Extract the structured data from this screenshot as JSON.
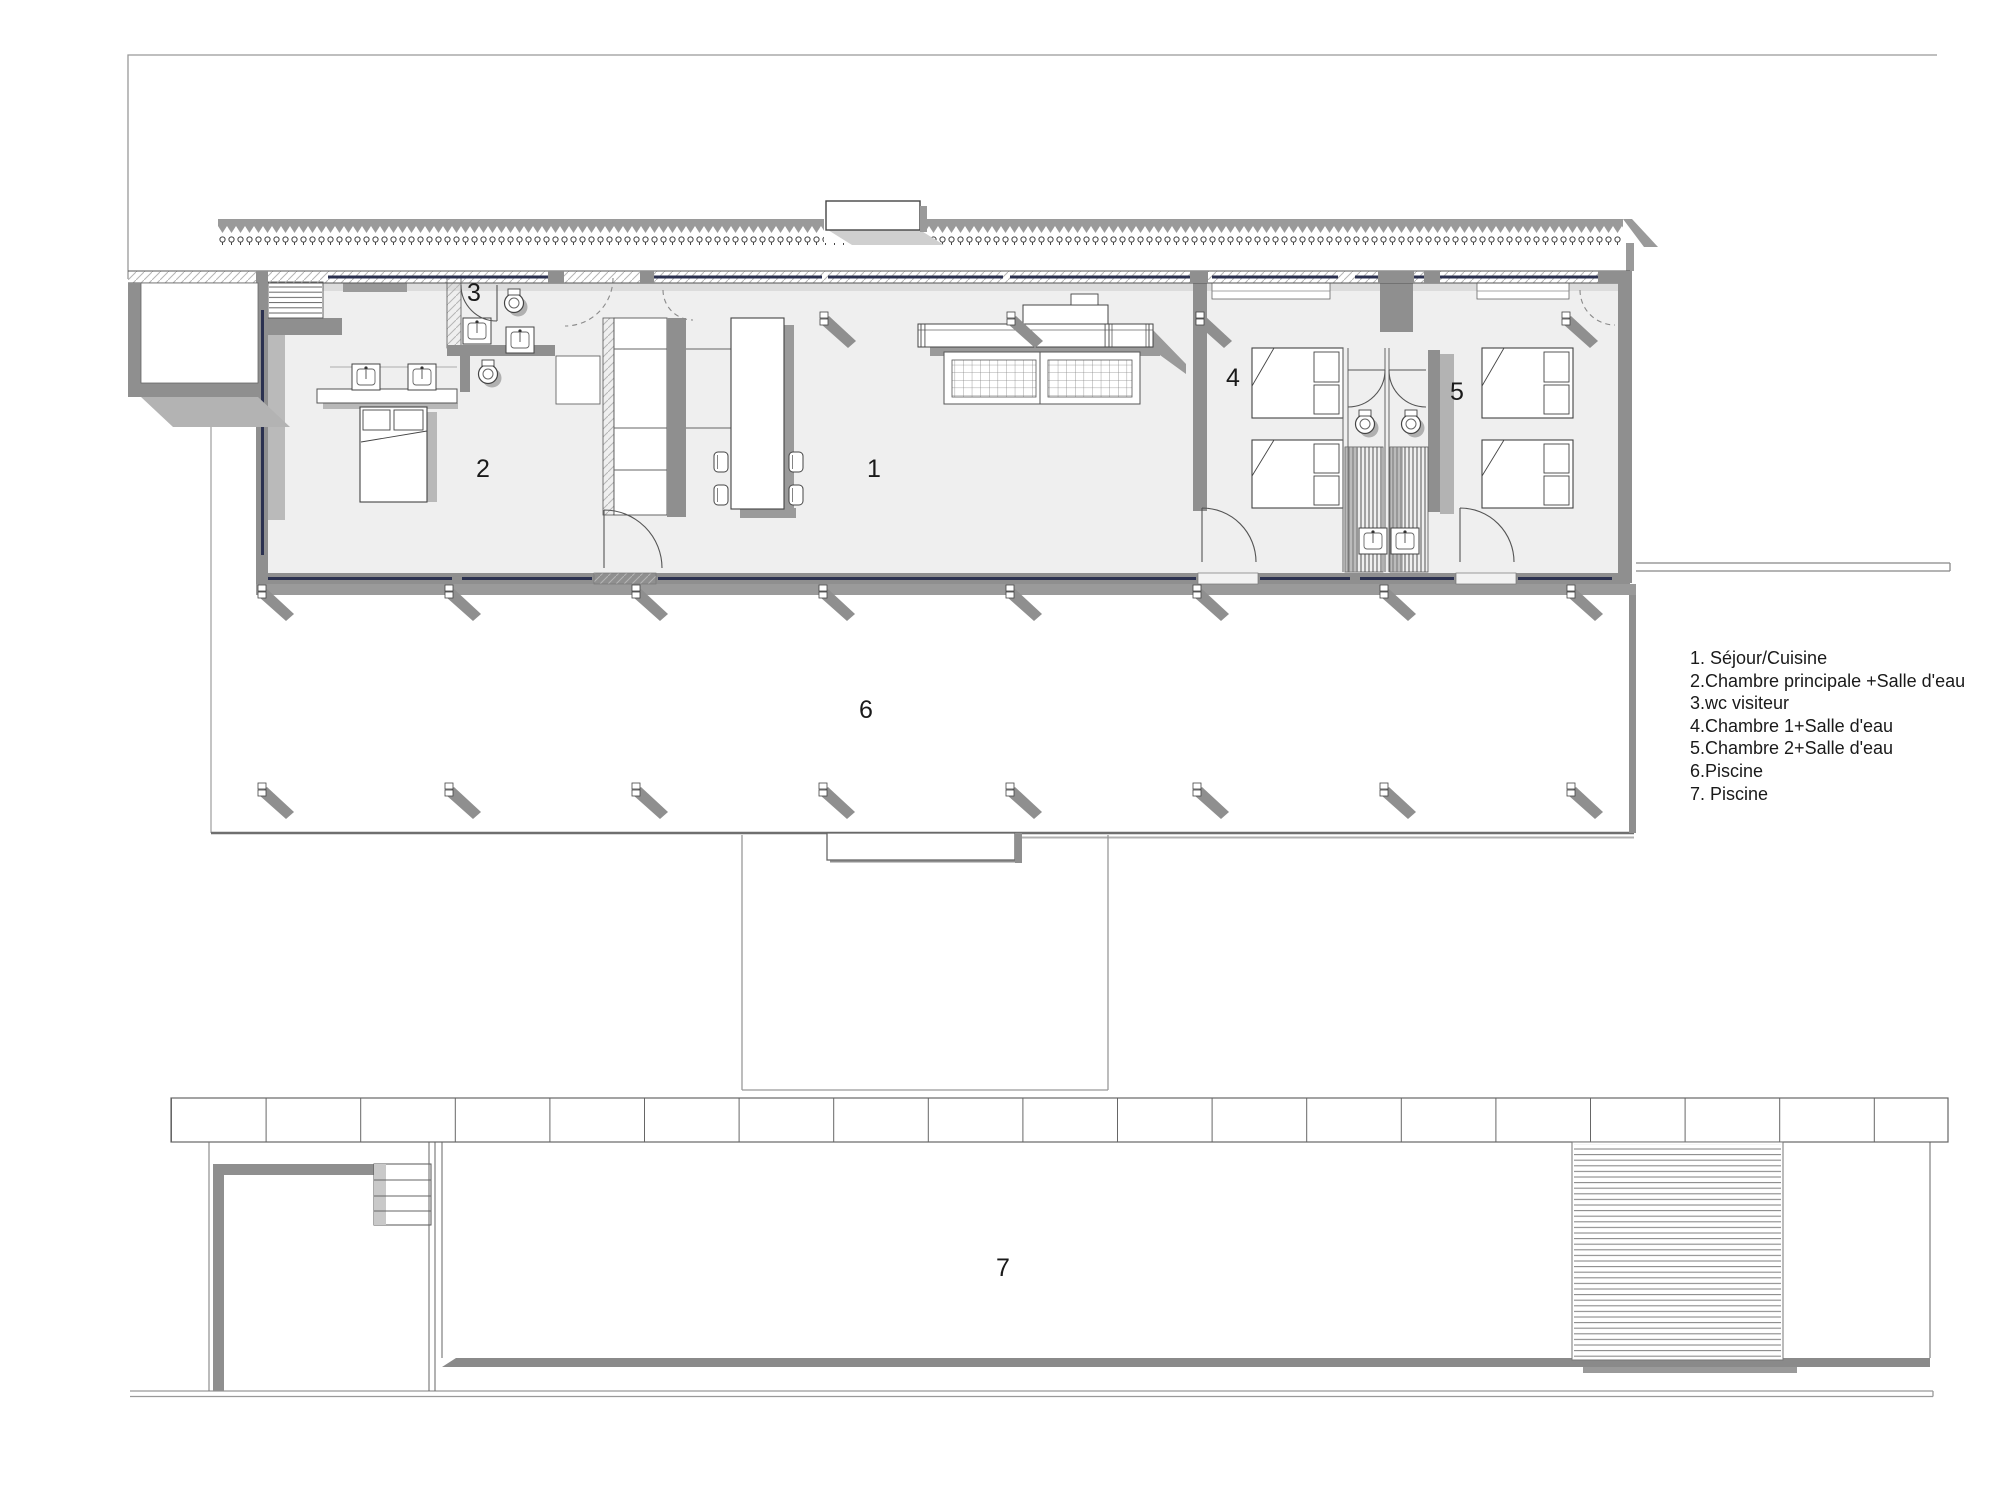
{
  "document": {
    "kind": "architectural floor plan",
    "language": "fr"
  },
  "legend": {
    "items": [
      "1. Séjour/Cuisine",
      "2.Chambre principale +Salle d'eau",
      "3.wc visiteur",
      "4.Chambre 1+Salle d'eau",
      "5.Chambre 2+Salle d'eau",
      "6.Piscine",
      "7. Piscine"
    ]
  },
  "plan": {
    "room_labels": [
      "1",
      "2",
      "3",
      "4",
      "5",
      "6",
      "7"
    ]
  },
  "colors": {
    "paper": "#ffffff",
    "floor": "#efefef",
    "wall": "#8f8f8f",
    "wall-dark": "#6f6f6f",
    "shadow": "#b3b3b3",
    "line": "#555555",
    "boundary": "#999999",
    "glazing": "#2b3150",
    "text": "#1a1a1a"
  }
}
